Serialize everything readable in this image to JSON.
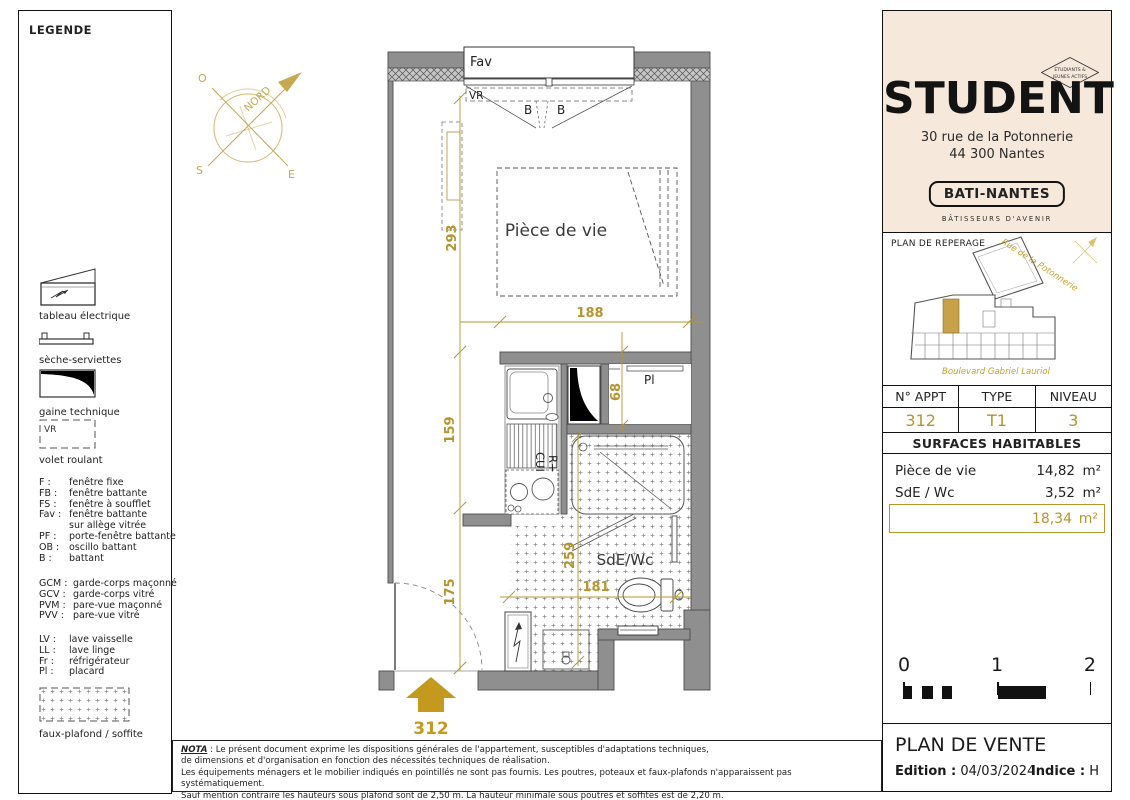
{
  "colors": {
    "gold": "#b6952f",
    "cream": "#f6e9dc",
    "wall": "#8f8f8f"
  },
  "legend": {
    "title": "LEGENDE",
    "items": [
      {
        "label": "tableau électrique"
      },
      {
        "label": "sèche-serviettes"
      },
      {
        "label": "gaine technique"
      },
      {
        "label": "volet roulant",
        "tag": "VR"
      }
    ],
    "windows": [
      {
        "abbr": "F :",
        "label": "fenêtre fixe"
      },
      {
        "abbr": "FB :",
        "label": "fenêtre battante"
      },
      {
        "abbr": "FS :",
        "label": "fenêtre à soufflet"
      },
      {
        "abbr": "Fav :",
        "label": "fenêtre battante"
      },
      {
        "abbr": "",
        "label": "sur allège vitrée"
      },
      {
        "abbr": "PF :",
        "label": "porte-fenêtre battante"
      },
      {
        "abbr": "OB :",
        "label": "oscillo battant"
      },
      {
        "abbr": "B :",
        "label": "battant"
      }
    ],
    "guards": [
      {
        "abbr": "GCM :",
        "label": "garde-corps maçonné"
      },
      {
        "abbr": "GCV :",
        "label": "garde-corps vitré"
      },
      {
        "abbr": "PVM :",
        "label": "pare-vue maçonné"
      },
      {
        "abbr": "PVV :",
        "label": "pare-vue vitré"
      }
    ],
    "equipment": [
      {
        "abbr": "LV :",
        "label": "lave vaisselle"
      },
      {
        "abbr": "LL :",
        "label": "lave linge"
      },
      {
        "abbr": "Fr :",
        "label": "réfrigérateur"
      },
      {
        "abbr": "Pl :",
        "label": "placard"
      }
    ],
    "faux_plafond": "faux-plafond / soffite"
  },
  "plan": {
    "compass": {
      "north": "NORD",
      "o": "O",
      "s": "S",
      "e": "E"
    },
    "window_label": "Fav",
    "vr_label": "VR",
    "b1": "B",
    "b2": "B",
    "living_label": "Pièce de vie",
    "bath_label": "SdE/Wc",
    "placard_label": "Pl",
    "kitchen_line1": "R+",
    "kitchen_line2": "CUI",
    "dims": {
      "v293": "293",
      "v159": "159",
      "v175": "175",
      "v68": "68",
      "v259": "259",
      "h188": "188",
      "h181": "181"
    },
    "entry_number": "312"
  },
  "nota": {
    "label": "NOTA",
    "line1": " : Le présent document exprime les dispositions générales de l'appartement, susceptibles d'adaptations techniques,",
    "line2": "de dimensions et d'organisation en fonction des nécessités techniques de réalisation.",
    "line3": "Les équipements ménagers et le mobilier indiqués en pointillés ne sont pas fournis. Les poutres, poteaux et faux-plafonds n'apparaissent pas systématiquement.",
    "line4": "Sauf mention contraire les hauteurs sous plafond sont de 2,50 m. La hauteur minimale sous poutres et soffites est de 2,20 m."
  },
  "sidebar": {
    "brand": {
      "name": "STUDENT",
      "badge1": "ÉTUDIANTS &",
      "badge2": "JEUNES ACTIFS",
      "address1": "30 rue de la Potonnerie",
      "address2": "44 300 Nantes",
      "builder": "BATI-NANTES",
      "tagline": "BÂTISSEURS D'AVENIR"
    },
    "reperage": {
      "title": "PLAN DE REPERAGE",
      "street_top": "Rue de la Potonnerie",
      "street_bottom": "Boulevard Gabriel Lauriol"
    },
    "table": {
      "h1": "N° APPT",
      "h2": "TYPE",
      "h3": "NIVEAU",
      "v1": "312",
      "v2": "T1",
      "v3": "3"
    },
    "surfaces": {
      "title": "SURFACES HABITABLES",
      "rows": [
        {
          "label": "Pièce de vie",
          "value": "14,82",
          "unit": "m²"
        },
        {
          "label": "SdE / Wc",
          "value": "3,52",
          "unit": "m²"
        }
      ],
      "total_value": "18,34",
      "total_unit": "m²"
    },
    "scale": {
      "t0": "0",
      "t1": "1",
      "t2": "2"
    },
    "footer": {
      "title": "PLAN DE VENTE",
      "edition_label": "Edition :",
      "edition_value": "04/03/2024",
      "indice_label": "Indice :",
      "indice_value": "H"
    }
  }
}
